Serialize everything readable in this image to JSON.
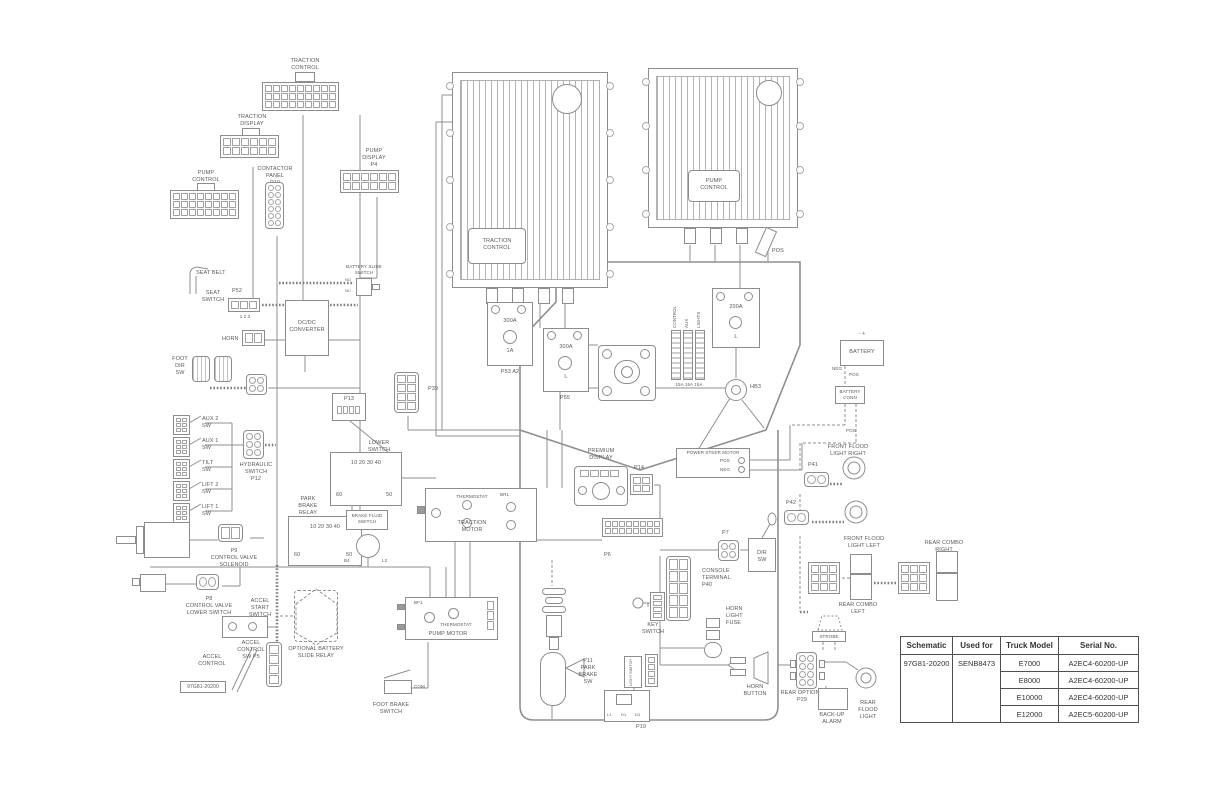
{
  "table": {
    "headers": [
      "Schematic",
      "Used for",
      "Truck Model",
      "Serial No."
    ],
    "schematic": "97G81-20200",
    "used_for": "SENB8473",
    "rows": [
      {
        "model": "E7000",
        "serial": "A2EC4-60200-UP"
      },
      {
        "model": "E8000",
        "serial": "A2EC4-60200-UP"
      },
      {
        "model": "E10000",
        "serial": "A2EC4-60200-UP"
      },
      {
        "model": "E12000",
        "serial": "A2EC5-60200-UP"
      }
    ]
  },
  "labels": {
    "p1": "TRACTION\nCONTROL\nP1",
    "p2": "TRACTION\nDISPLAY\nP2",
    "p3": "PUMP\nCONTROL\nP3",
    "p10": "CONTACTOR\nPANEL\nP10",
    "p4": "PUMP\nDISPLAY\nP4",
    "traction_module": "TRACTION\nCONTROL",
    "pump_module": "PUMP\nCONTROL",
    "seat_belt": "SEAT BELT",
    "seat_switch": "SEAT\nSWITCH",
    "p52": "P52",
    "p52_pins": "1    2    3",
    "battery_slide": "BATTERY SLIDE\nSWITCH",
    "no": "NO",
    "nc": "NC",
    "dcdc": "DC/DC\nCONVERTER",
    "horn": "HORN",
    "foot_dir": "FOOT\nDIR\nSW",
    "p39": "P39",
    "p13": "P13",
    "aux2": "AUX 2\nSW",
    "aux1": "AUX 1\nSW",
    "tilt": "TILT\nSW",
    "lift2": "LIFT 2\nSW",
    "lift1": "LIFT 1\nSW",
    "hyd": "HYDRAULIC\nSWITCH\nP12",
    "lower_relay": "LOWER\nSWITCH\nRELAY",
    "park_relay": "PARK\nBRAKE\nRELAY",
    "relay_pins": "10 20      30 40",
    "pin60": "60",
    "pin50": "50",
    "brake_fluid": "BRAKE FLUID\nSWITCH",
    "b4": "B4",
    "l2": "L2",
    "p9": "P9\nCONTROL VALVE\nSOLENOID",
    "p8": "P8\nCONTROL VALVE\nLOWER SWITCH",
    "accel_start": "ACCEL\nSTART\nSWITCH",
    "accel_control": "ACCEL\nCONTROL",
    "p5": "ACCEL\nCONTROL\nSW P5",
    "schem_no": "97G81-20200",
    "opt_relay": "OPTIONAL BATTERY\nSLIDE RELAY",
    "foot_brake": "FOOT BRAKE\nSWITCH",
    "com": "COM",
    "traction_motor": "TRACTION\nMOTOR",
    "thermostat": "THERMOSTAT",
    "br1": "BR1",
    "pump_motor": "PUMP MOTOR",
    "bf1": "BF1",
    "p11": "P11\nPARK\nBRAKE\nSW",
    "premium": "PREMIUM\nDISPLAY",
    "steer": "POWER STEER MOTOR",
    "pos": "POS",
    "neg": "NEG",
    "p14": "P14",
    "p6": "P6",
    "p7": "P7",
    "console": "CONSOLE\nTERMINAL\nP40",
    "dir_sw": "DIR\nSW",
    "key_switch": "KEY\nSWITCH",
    "horn_fuse": "HORN\nLIGHT\nFUSE",
    "light_switch": "LIGHT\nSWITCH",
    "p19": "P19",
    "l1": "L1",
    "d1": "D1",
    "d2": "D2",
    "horn_button": "HORN\nBUTTON",
    "p29": "REAR OPTIONS\nP29",
    "strobe": "STROBE",
    "backup": "BACK-UP\nALARM",
    "rear_flood": "REAR\nFLOOD\nLIGHT",
    "battery": "BATTERY",
    "batt_terms": "-        +",
    "battery_conn": "BATTERY\nCONN",
    "ffr": "FRONT FLOOD\nLIGHT RIGHT",
    "ffl": "FRONT FLOOD\nLIGHT LEFT",
    "p41": "P41",
    "p42": "P42",
    "rcl": "REAR COMBO\nLEFT",
    "rcr": "REAR COMBO\nRIGHT",
    "f300": "300A",
    "f200": "200A",
    "c1a": "1A",
    "cl": "L",
    "p53a2": "P53    A2",
    "p55": "P55",
    "fuse_control": "CONTROL",
    "fuse_aux": "AUX",
    "fuse_lights": "LIGHTS",
    "amps": "15A 15A 15A",
    "hb3": "HB3"
  }
}
